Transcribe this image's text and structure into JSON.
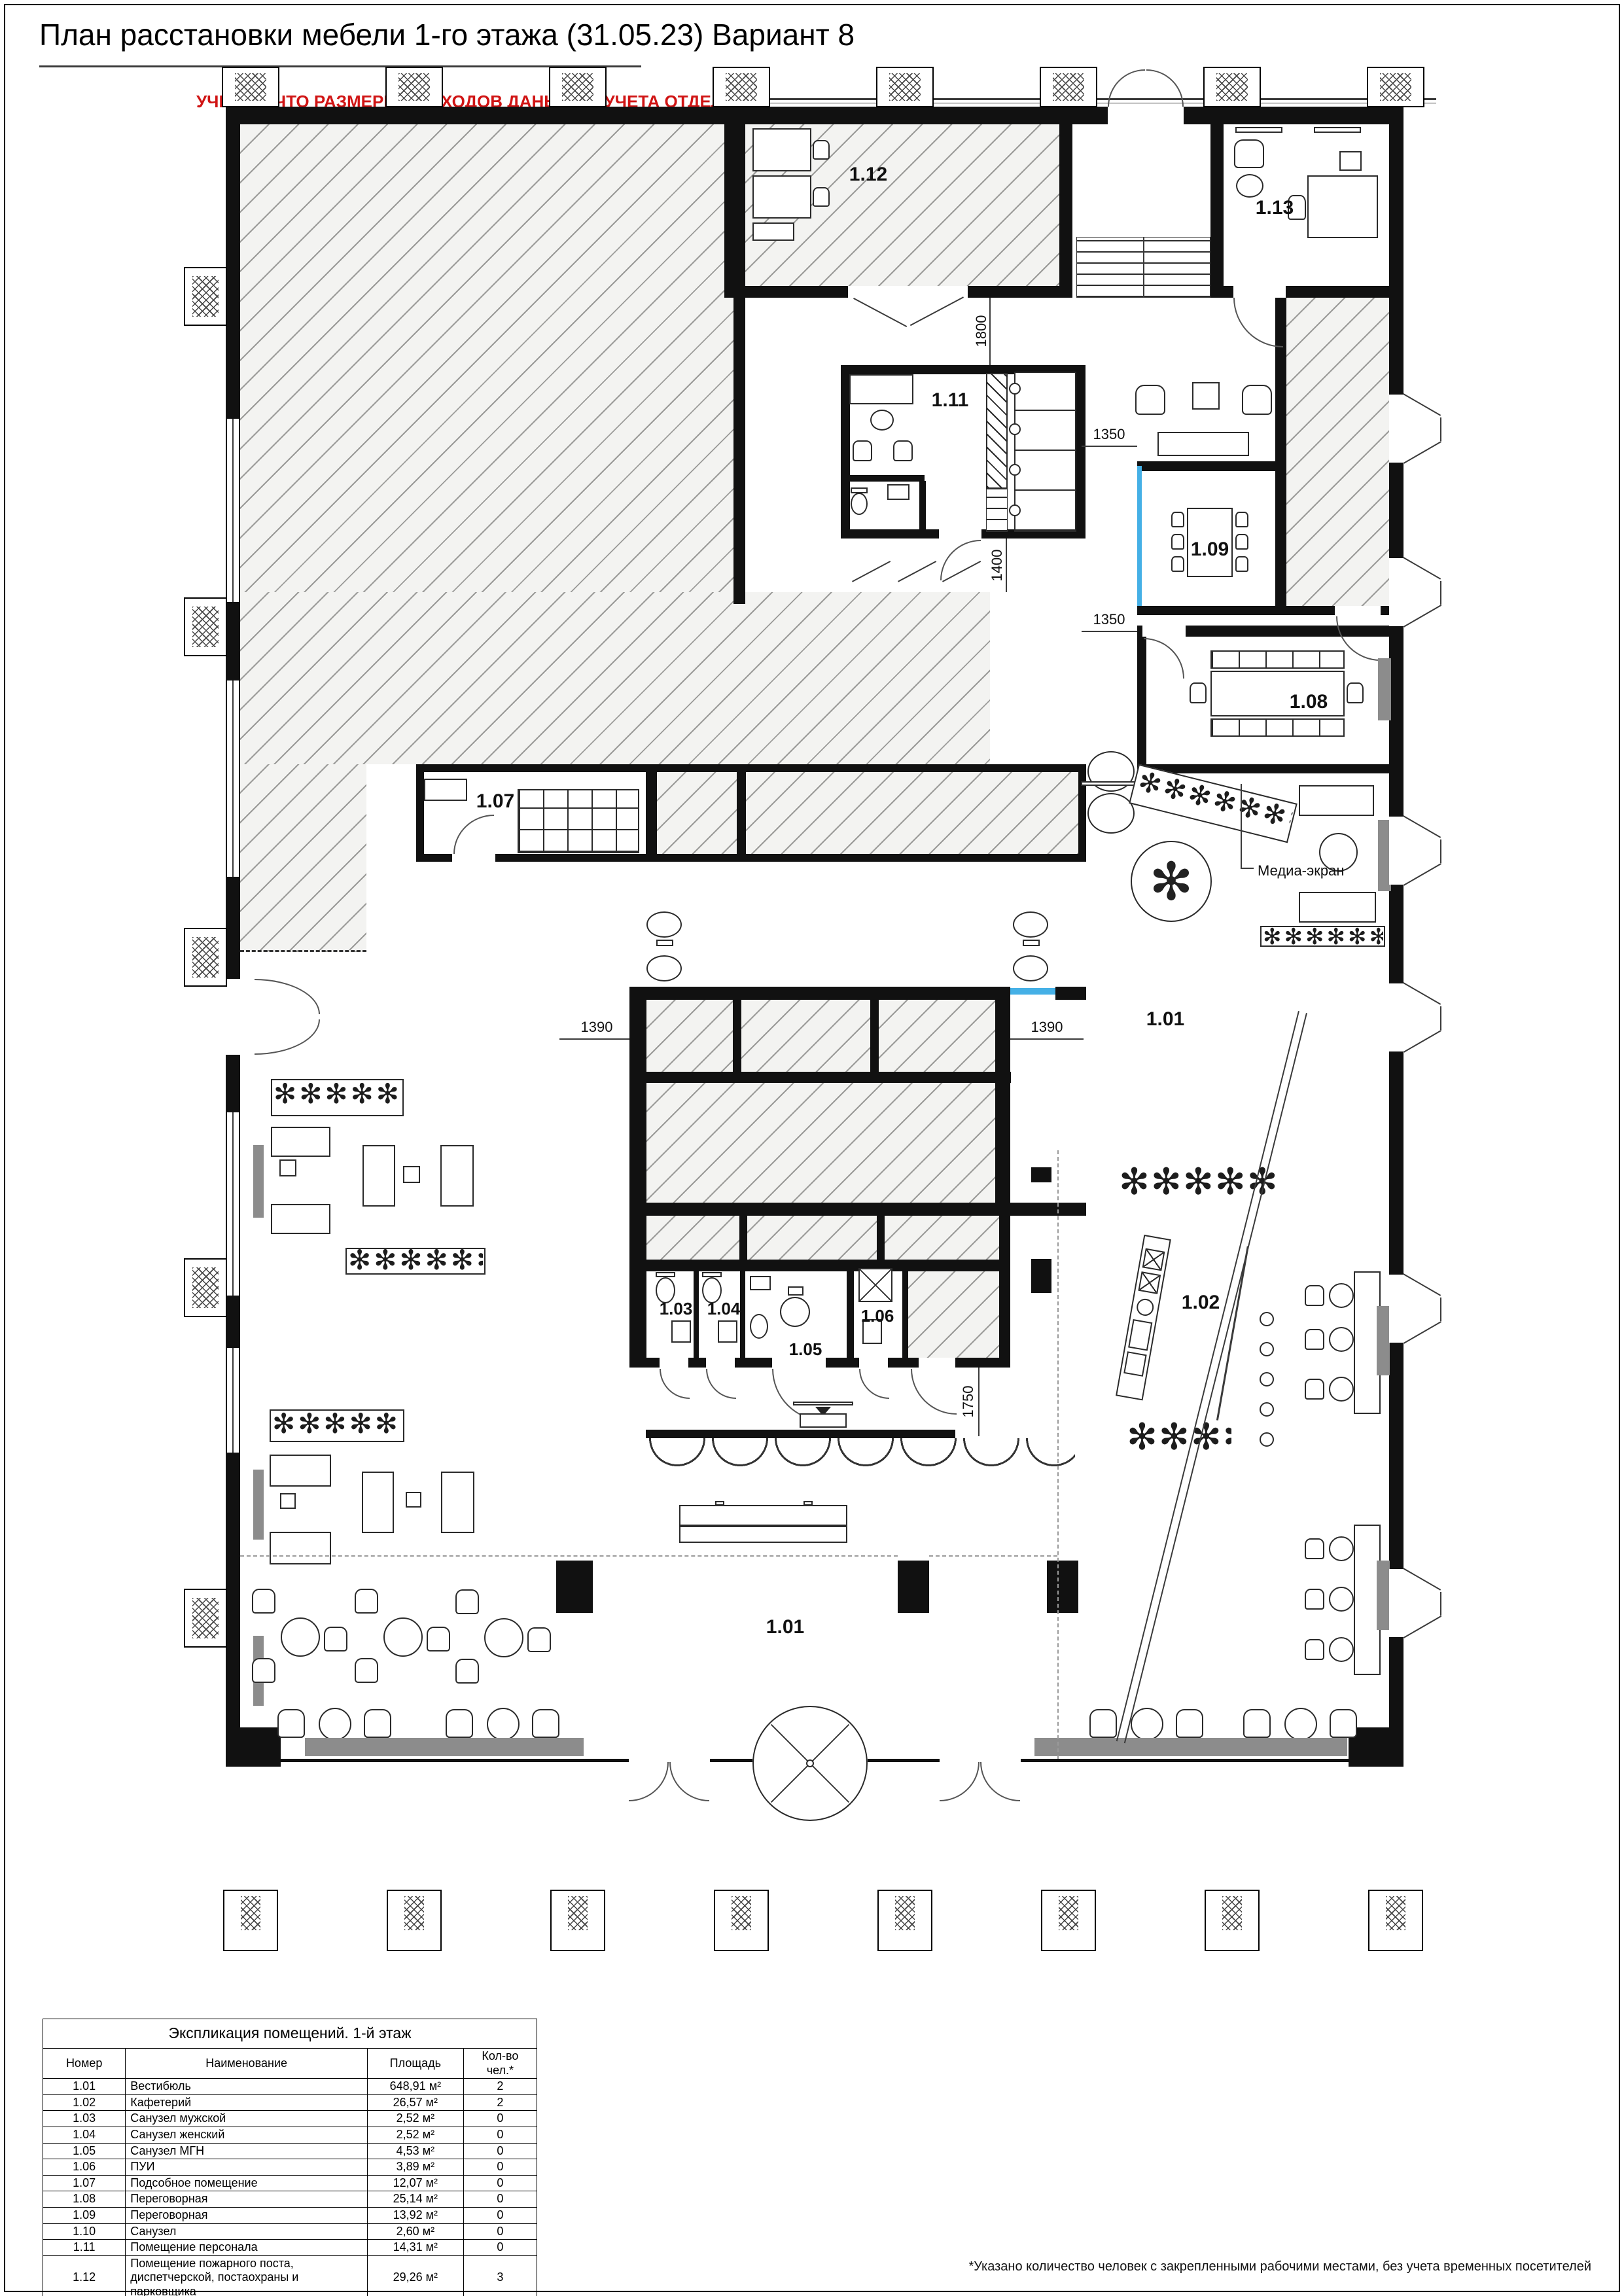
{
  "sheet": {
    "title": "План расстановки мебели 1-го этажа (31.05.23) Вариант 8",
    "warning": "УЧЕСТЬ, ЧТО РАЗМЕРЫ ПРОХОДОВ ДАНЫ БЕЗ УЧЕТА ОТДЕЛКИ!",
    "footnote": "*Указано количество человек с закрепленными рабочими местами, без учета временных посетителей"
  },
  "plan": {
    "room_tags": {
      "r101a": "1.01",
      "r101b": "1.01",
      "r102": "1.02",
      "r103": "1.03",
      "r104": "1.04",
      "r105": "1.05",
      "r106": "1.06",
      "r107": "1.07",
      "r108": "1.08",
      "r109": "1.09",
      "r111": "1.11",
      "r112": "1.12",
      "r113": "1.13"
    },
    "dimensions": {
      "d1800": "1800",
      "d1400": "1400",
      "d1350a": "1350",
      "d1350b": "1350",
      "d1390a": "1390",
      "d1390b": "1390",
      "d1750": "1750"
    },
    "annotations": {
      "media_screen_label": "Медиа-экран"
    },
    "decor": {
      "plants": "✻✻✻✻✻✻✻✻",
      "plant": "✻"
    }
  },
  "legend": {
    "title": "Экспликация помещений. 1-й этаж",
    "columns": [
      "Номер",
      "Наименование",
      "Площадь",
      "Кол-во чел.*"
    ],
    "rows": [
      {
        "num": "1.01",
        "name": "Вестибюль",
        "area": "648,91 м²",
        "people": "2"
      },
      {
        "num": "1.02",
        "name": "Кафетерий",
        "area": "26,57 м²",
        "people": "2"
      },
      {
        "num": "1.03",
        "name": "Санузел мужской",
        "area": "2,52 м²",
        "people": "0"
      },
      {
        "num": "1.04",
        "name": "Санузел женский",
        "area": "2,52 м²",
        "people": "0"
      },
      {
        "num": "1.05",
        "name": "Санузел МГН",
        "area": "4,53 м²",
        "people": "0"
      },
      {
        "num": "1.06",
        "name": "ПУИ",
        "area": "3,89 м²",
        "people": "0"
      },
      {
        "num": "1.07",
        "name": "Подсобное помещение",
        "area": "12,07 м²",
        "people": "0"
      },
      {
        "num": "1.08",
        "name": "Переговорная",
        "area": "25,14 м²",
        "people": "0"
      },
      {
        "num": "1.09",
        "name": "Переговорная",
        "area": "13,92 м²",
        "people": "0"
      },
      {
        "num": "1.10",
        "name": "Санузел",
        "area": "2,60 м²",
        "people": "0"
      },
      {
        "num": "1.11",
        "name": "Помещение персонала",
        "area": "14,31 м²",
        "people": "0"
      },
      {
        "num": "1.12",
        "name": "Помещение пожарного поста, диспетчерской, постаохраны и парковщика",
        "area": "29,26 м²",
        "people": "3"
      },
      {
        "num": "1.13",
        "name": "Помещение охраны",
        "area": "16,00 м²",
        "people": "2"
      }
    ],
    "total": {
      "area": "802,26 м²",
      "people": "9"
    }
  }
}
